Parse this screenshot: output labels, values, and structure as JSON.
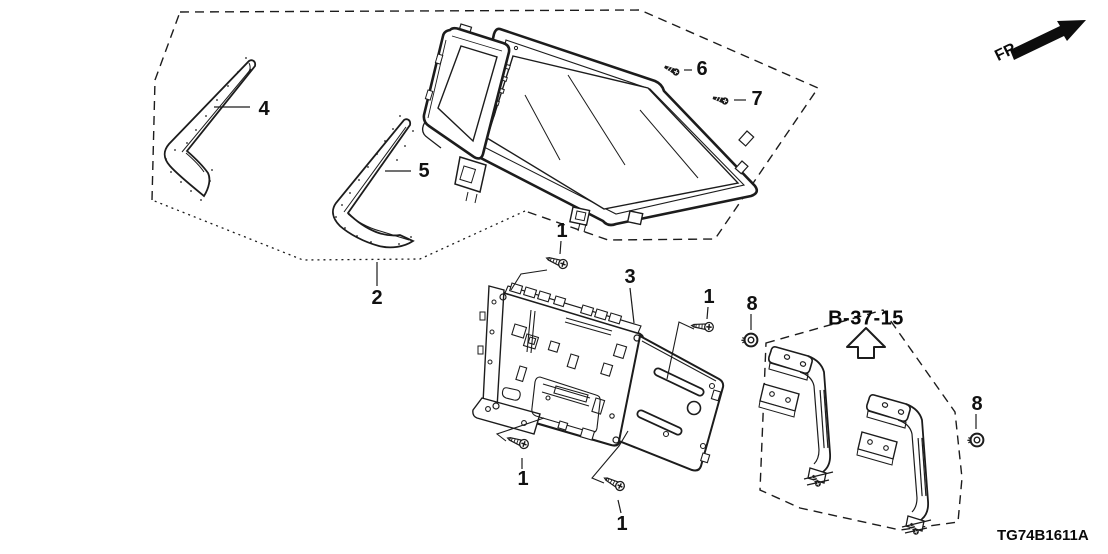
{
  "diagram": {
    "code": "TG74B1611A",
    "direction_label": "FR.",
    "reference_label": "B-37-15"
  },
  "callouts": {
    "n4": {
      "label": "4"
    },
    "n5": {
      "label": "5"
    },
    "n2": {
      "label": "2"
    },
    "n6": {
      "label": "6"
    },
    "n7": {
      "label": "7"
    },
    "n3": {
      "label": "3"
    },
    "n1_top": {
      "label": "1"
    },
    "n1_right": {
      "label": "1"
    },
    "n1_bottom_left": {
      "label": "1"
    },
    "n1_bottom_center": {
      "label": "1"
    },
    "n8_left": {
      "label": "8"
    },
    "n8_right": {
      "label": "8"
    }
  }
}
